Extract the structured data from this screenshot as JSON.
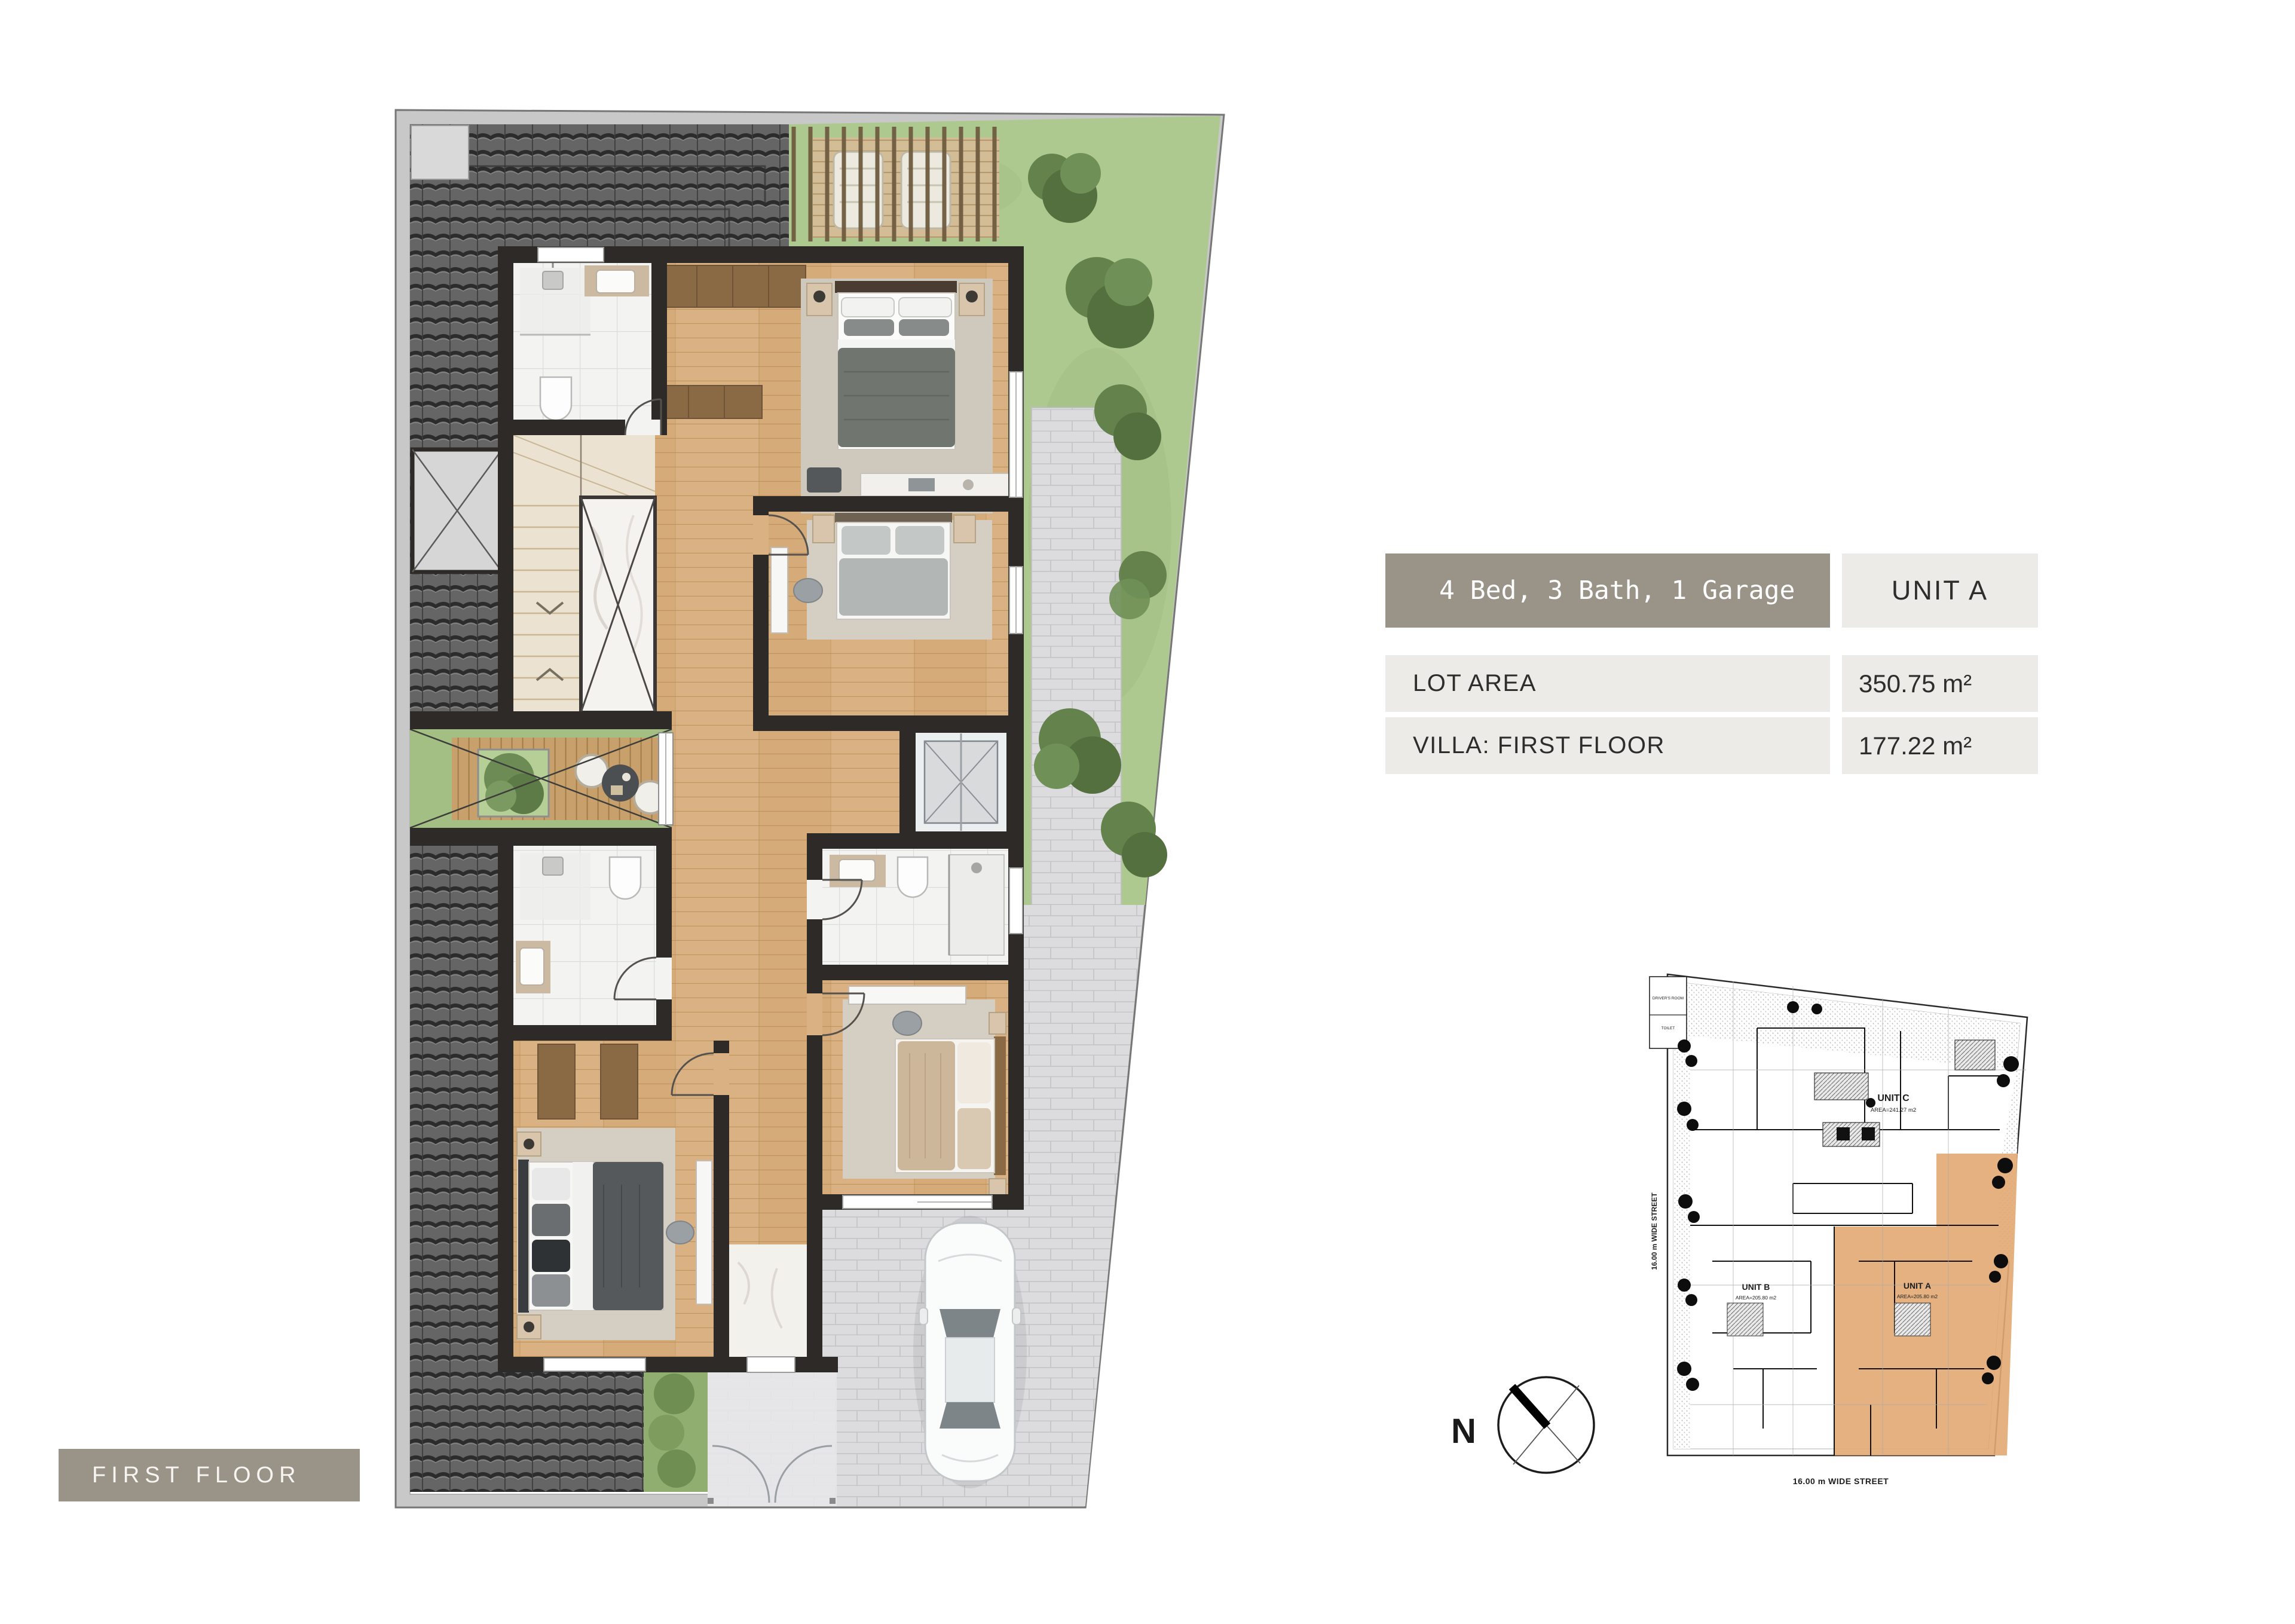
{
  "info_table": {
    "summary": "4 Bed, 3 Bath, 1 Garage",
    "unit": "UNIT A",
    "rows": [
      {
        "label": "LOT AREA",
        "value": "350.75 m²"
      },
      {
        "label": "VILLA: FIRST FLOOR",
        "value": "177.22 m²"
      }
    ],
    "colors": {
      "header_bg": "#9a9388",
      "cell_bg": "#edebe7",
      "header_text": "#ffffff",
      "text": "#2e2d2b"
    }
  },
  "floor_badge": {
    "label": "FIRST FLOOR",
    "bg": "#9a9388",
    "text_color": "#f7f5f1"
  },
  "site_plan": {
    "units": [
      {
        "name": "UNIT C",
        "area": "AREA=241.27 m2"
      },
      {
        "name": "UNIT B",
        "area": "AREA=205.80 m2"
      },
      {
        "name": "UNIT A",
        "area": "AREA=205.80 m2"
      }
    ],
    "annex_labels": [
      "DRIVER'S ROOM",
      "TOILET"
    ],
    "street_label_bottom": "16.00 m WIDE STREET",
    "street_label_left": "16.00 m WIDE STREET",
    "highlight_color": "#e2a873",
    "compass": {
      "north_label": "N"
    }
  },
  "floor_plan": {
    "colors": {
      "walls": "#2d2a27",
      "roof_tiles": "#656565",
      "wood_floor": "#d9b182",
      "grass": "#aec98f",
      "pavers": "#dcdcde",
      "courtyard_deck": "#c7a06b",
      "stairs": "#ece2d2",
      "bathroom_tile": "#f3f3f2",
      "boundary_band": "#c8c8c8",
      "rug": "#cfc9bd"
    }
  }
}
